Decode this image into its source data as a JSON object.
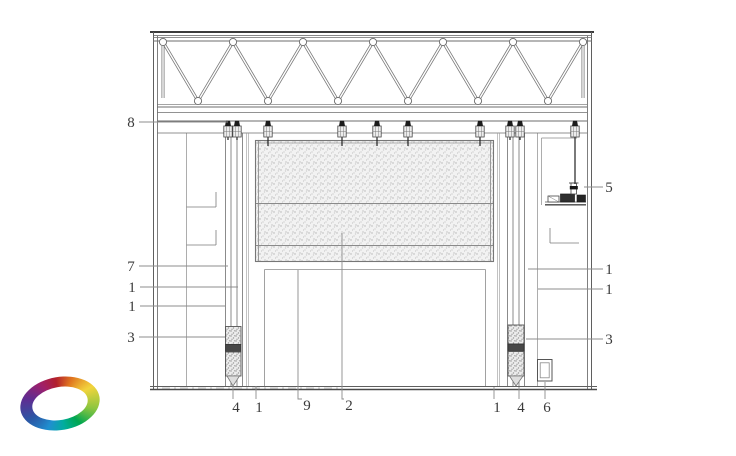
{
  "callouts": [
    {
      "label": "8",
      "x": 131,
      "y": 122,
      "leader": [
        [
          139,
          122
        ],
        [
          228,
          122
        ]
      ]
    },
    {
      "label": "7",
      "x": 131,
      "y": 266,
      "leader": [
        [
          139,
          266
        ],
        [
          228,
          266
        ]
      ]
    },
    {
      "label": "1",
      "x": 132,
      "y": 287,
      "leader": [
        [
          140,
          287
        ],
        [
          238,
          287
        ]
      ]
    },
    {
      "label": "1",
      "x": 132,
      "y": 306,
      "leader": [
        [
          140,
          306
        ],
        [
          225,
          306
        ]
      ]
    },
    {
      "label": "3",
      "x": 131,
      "y": 337,
      "leader": [
        [
          139,
          337
        ],
        [
          225,
          337
        ]
      ]
    },
    {
      "label": "5",
      "x": 609,
      "y": 187,
      "leader": [
        [
          603,
          187
        ],
        [
          584,
          187
        ]
      ]
    },
    {
      "label": "1",
      "x": 609,
      "y": 269,
      "leader": [
        [
          603,
          269
        ],
        [
          528,
          269
        ]
      ]
    },
    {
      "label": "1",
      "x": 609,
      "y": 289,
      "leader": [
        [
          603,
          289
        ],
        [
          538,
          289
        ]
      ]
    },
    {
      "label": "3",
      "x": 609,
      "y": 339,
      "leader": [
        [
          603,
          339
        ],
        [
          526,
          339
        ]
      ]
    },
    {
      "label": "4",
      "x": 236,
      "y": 407,
      "leader": [
        [
          233,
          399
        ],
        [
          233,
          386
        ]
      ]
    },
    {
      "label": "1",
      "x": 259,
      "y": 407,
      "leader": [
        [
          256,
          399
        ],
        [
          256,
          386
        ]
      ]
    },
    {
      "label": "9",
      "x": 307,
      "y": 405,
      "leader": [
        [
          302,
          399
        ],
        [
          298,
          399
        ],
        [
          298,
          270
        ]
      ]
    },
    {
      "label": "2",
      "x": 349,
      "y": 405,
      "leader": [
        [
          344,
          399
        ],
        [
          342,
          399
        ],
        [
          342,
          233
        ]
      ]
    },
    {
      "label": "1",
      "x": 497,
      "y": 407,
      "leader": [
        [
          494,
          399
        ],
        [
          494,
          387
        ]
      ]
    },
    {
      "label": "4",
      "x": 521,
      "y": 407,
      "leader": [
        [
          519,
          399
        ],
        [
          519,
          387
        ]
      ]
    },
    {
      "label": "6",
      "x": 547,
      "y": 407,
      "leader": [
        [
          545,
          399
        ],
        [
          545,
          382
        ]
      ]
    }
  ],
  "logo": {
    "name": "rainbow-swirl-logo",
    "colors": [
      "#b21f2d",
      "#e0761f",
      "#f2d43c",
      "#8dc63f",
      "#00a651",
      "#00ad9e",
      "#1f8fd0",
      "#2b57a5",
      "#5f2c91",
      "#a0206a",
      "#b21f2d"
    ]
  }
}
